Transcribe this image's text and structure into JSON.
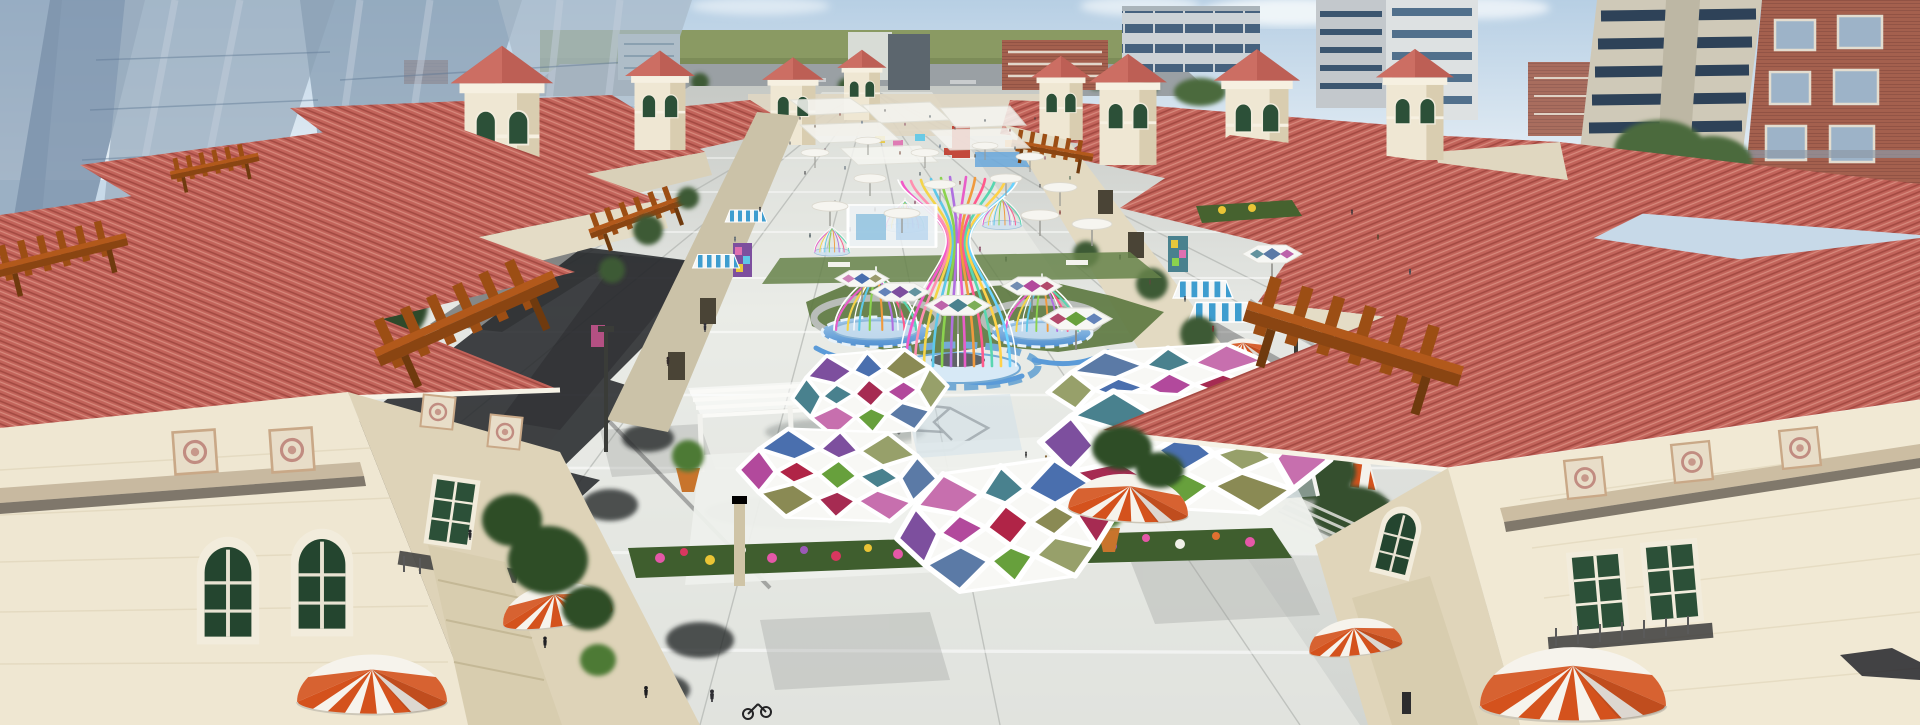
{
  "scene": {
    "type": "3d-architectural-rendering",
    "description": "Aerial daytime rendering of a Mediterranean-style open-air shopping street: symmetric rows of red-tile-roof buildings flank a paved pedestrian plaza with colorful hexagonal glass canopies, ribbon birdcage pavilions on blue fountain bases, white umbrellas, orange-and-white striped dome awnings, wooden pergolas, outdoor cafe seating, flower beds and crowds of visitors; glass skyscrapers and apartment towers rise in the background.",
    "setting": "outdoor retail plaza",
    "style": "mediterranean shopping village",
    "weather": "clear",
    "crowd_estimate": "~150 pedestrians"
  },
  "palette": {
    "sky": "#bdd3e6",
    "cloud": "#f4f8fb",
    "horizon_green": "#8a9a63",
    "road_gray": "#9aa0a4",
    "glass_tower": "#93a7bc",
    "glass_highlight": "#b6c3d2",
    "roof_tile": "#c2635a",
    "roof_tile_light": "#d78a7d",
    "roof_tile_dark": "#a34a42",
    "wall_cream": "#efe7d2",
    "wall_shade": "#ded3b8",
    "trim_white": "#f6f0e1",
    "paving_light": "#e4e6e2",
    "paving_mid": "#c9ccc8",
    "shadow_dark": "#27292c",
    "grass": "#5e7a42",
    "pool_blue": "#5b9bd8",
    "pool_light": "#a8cdec",
    "pergola_wood": "#b2591b",
    "awning_orange": "#d4521d",
    "awning_blue": "#3e9dcf",
    "window_green": "#2c5038",
    "brick": "#a4604e",
    "canopy_frame": "#f8f8f5",
    "panel_colors": [
      "#a62b52",
      "#b2499c",
      "#7d4f9e",
      "#4a6fae",
      "#49818e",
      "#8a8a54",
      "#67a03c",
      "#97a06a",
      "#5b7aa6",
      "#c76fae"
    ],
    "ribbon_colors": [
      "#e85dc8",
      "#f4d44a",
      "#5ec8e8",
      "#8bd34e",
      "#f09a3e",
      "#b070e0",
      "#ff5a8c",
      "#59d6b0"
    ]
  },
  "elements": {
    "hex_glass_canopies": 5,
    "small_hex_umbrellas": 6,
    "ribbon_pavilions": 6,
    "striped_dome_awnings": 6,
    "wooden_pergolas": 5,
    "roof_towers": 8,
    "white_umbrellas": 14,
    "cafe_tables": 5,
    "flower_beds": 3
  }
}
